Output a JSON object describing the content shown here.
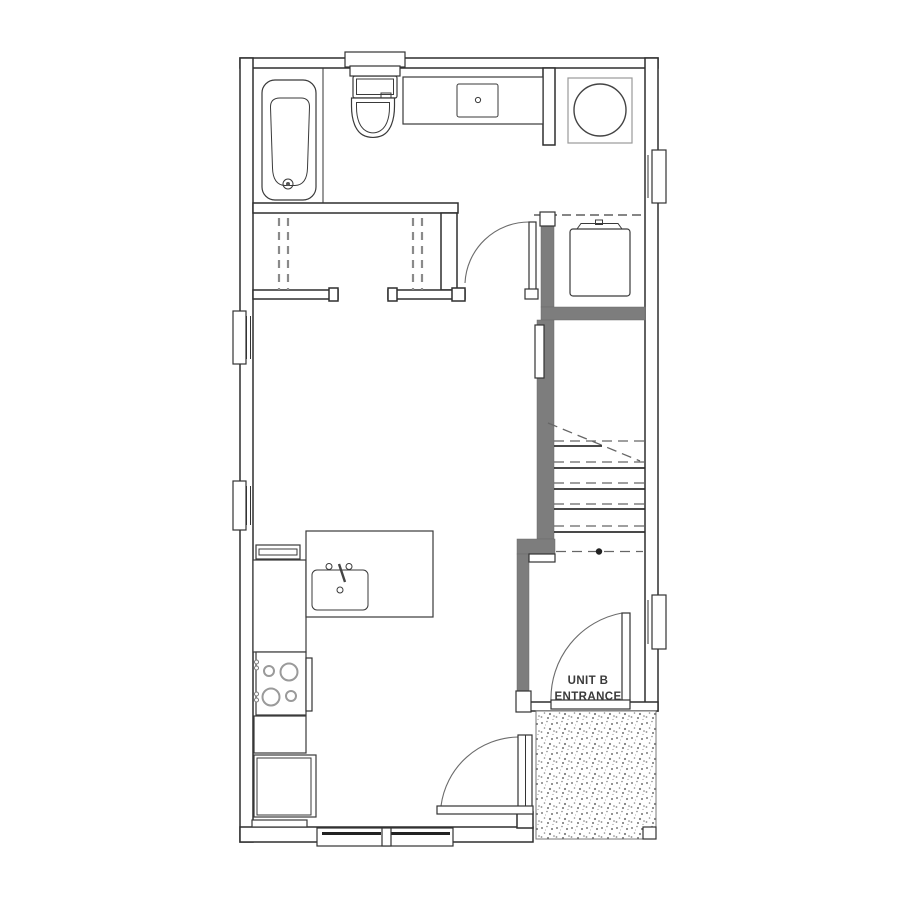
{
  "page": {
    "background": "#ffffff",
    "kind": "architectural floor plan"
  },
  "plan": {
    "unit_label": {
      "line1": "UNIT B",
      "line2": "ENTRANCE"
    },
    "colors": {
      "wall_line": "#2f2f2f",
      "light_line": "#9a9a9a",
      "poche_gray": "#7d7d7d",
      "stipple_dot": "#7e7e7e",
      "label_text": "#3a3a3a",
      "swing_arc": "#6b6b6b",
      "dashed_overhead": "#5f5f5f"
    },
    "fixtures": [
      "bathtub",
      "toilet",
      "vanity-sink",
      "washer-dryer",
      "water-heater",
      "closet-rods",
      "kitchen-shelf",
      "kitchen-peninsula",
      "kitchen-sink",
      "range-stove",
      "base-cabinet",
      "refrigerator",
      "stairs",
      "entry-door",
      "patio-door",
      "bedroom-door",
      "entry-stoop",
      "porch-post"
    ],
    "windows": [
      "left-upper",
      "left-lower",
      "right-upper",
      "right-lower",
      "top-bath",
      "bottom-living"
    ]
  }
}
